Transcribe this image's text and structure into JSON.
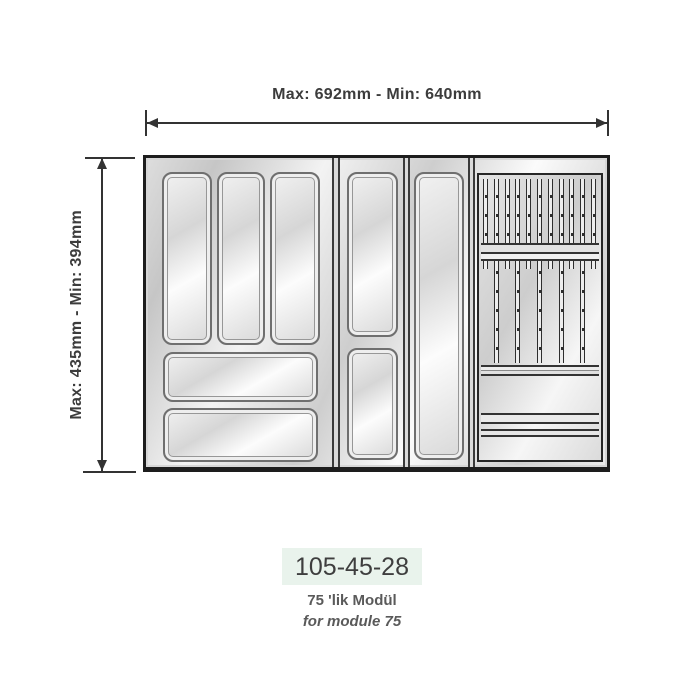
{
  "product": {
    "code": "105-45-28",
    "title_line1": "75 'lik Modül",
    "title_line2": "for module 75"
  },
  "dimensions": {
    "width_label": "Max: 692mm - Min: 640mm",
    "depth_label": "Max: 435mm - Min: 394mm"
  },
  "diagram": {
    "type": "cutlery-tray-top-view",
    "modules": [
      {
        "name": "left-module",
        "vertical_slots": 3,
        "wide_horizontal_slots": 2
      },
      {
        "name": "middle-module-1",
        "vertical_slots": 2
      },
      {
        "name": "middle-module-2",
        "vertical_slots": 1
      },
      {
        "name": "knife-block-module",
        "knife_slats": 11,
        "long_slats": 5,
        "lower_compartments": 2
      }
    ]
  },
  "colors": {
    "page_bg": "#ffffff",
    "code_box_bg": "#e9f3ec",
    "dimension_text": "#3c3c3c",
    "caption_text": "#5a5a5a",
    "outline": "#1d1d1d",
    "tray_metal_light": "#f6f6f6",
    "tray_metal_dark": "#c6c6c6"
  }
}
